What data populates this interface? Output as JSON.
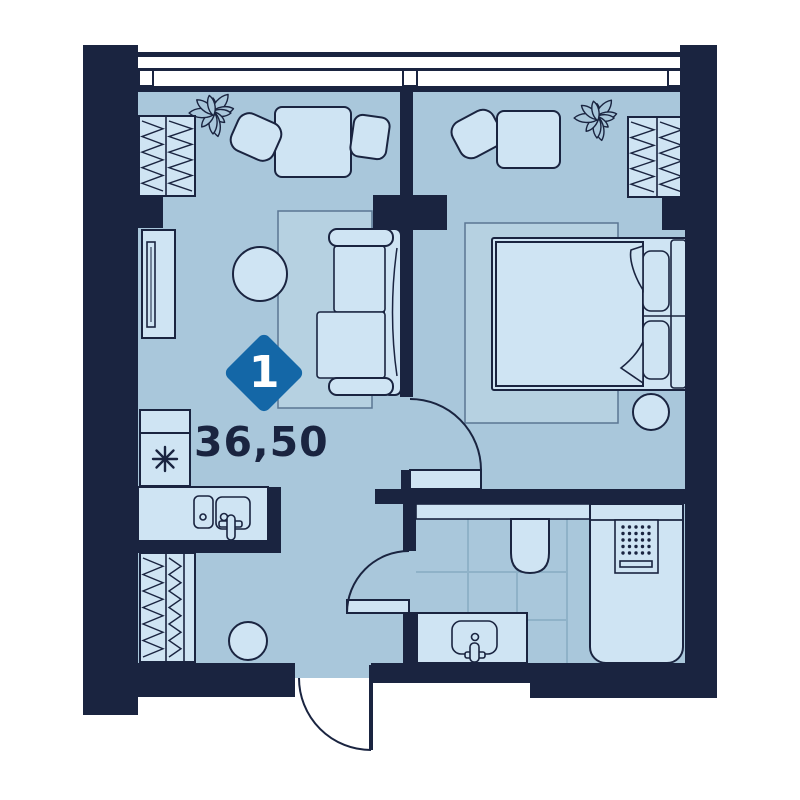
{
  "plan": {
    "badge": {
      "rooms_count": "1"
    },
    "area_label": "36,50"
  },
  "colors": {
    "page_bg": "#ffffff",
    "wall": "#1a2440",
    "floor": "#a9c7db",
    "furniture": "#cfe4f3",
    "rug": "#b6d1e1",
    "rug_line": "#5a7693",
    "tile_line": "#8fb2c8",
    "badge": "#1467a7",
    "text": "#1a2440"
  },
  "icons": {
    "plant": "flower-icon",
    "refrigerator_mark": "snowflake-icon",
    "shower_fixture": "dots-grid-icon"
  }
}
